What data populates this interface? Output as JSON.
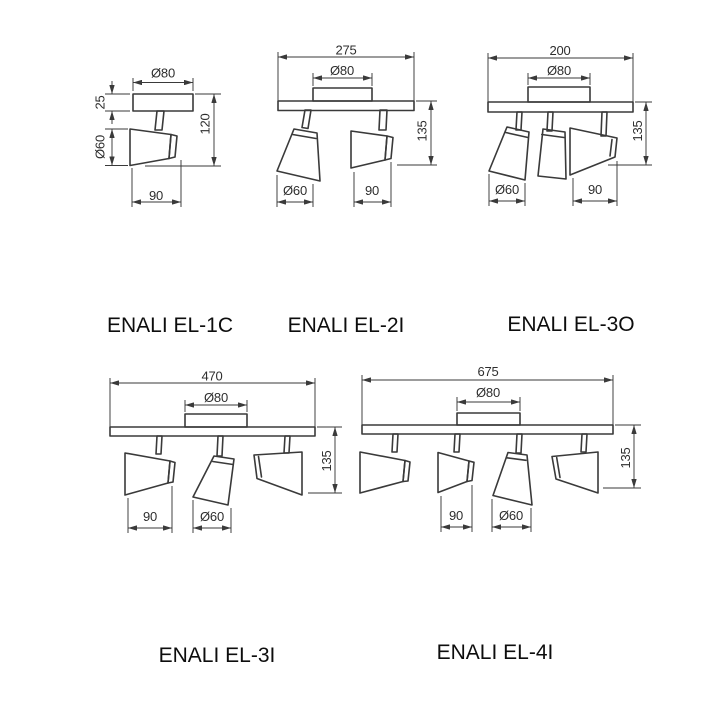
{
  "page": {
    "background_color": "#ffffff",
    "line_color": "#3a3a3a",
    "label_color": "#0d0d0d"
  },
  "products": [
    {
      "label": "ENALI EL-1C",
      "dims": {
        "canopy_diameter": "Ø80",
        "canopy_depth": "25",
        "head_diameter": "Ø60",
        "overall_depth": "120",
        "head_length": "90"
      }
    },
    {
      "label": "ENALI EL-2I",
      "dims": {
        "overall_length": "275",
        "canopy_diameter": "Ø80",
        "overall_depth": "135",
        "head_diameter": "Ø60",
        "head_length": "90"
      }
    },
    {
      "label": "ENALI EL-3O",
      "dims": {
        "overall_length": "200",
        "canopy_diameter": "Ø80",
        "overall_depth": "135",
        "head_diameter": "Ø60",
        "head_length": "90"
      }
    },
    {
      "label": "ENALI EL-3I",
      "dims": {
        "overall_length": "470",
        "canopy_diameter": "Ø80",
        "overall_depth": "135",
        "head_length": "90",
        "head_diameter": "Ø60"
      }
    },
    {
      "label": "ENALI EL-4I",
      "dims": {
        "overall_length": "675",
        "canopy_diameter": "Ø80",
        "overall_depth": "135",
        "head_length": "90",
        "head_diameter": "Ø60"
      }
    }
  ]
}
